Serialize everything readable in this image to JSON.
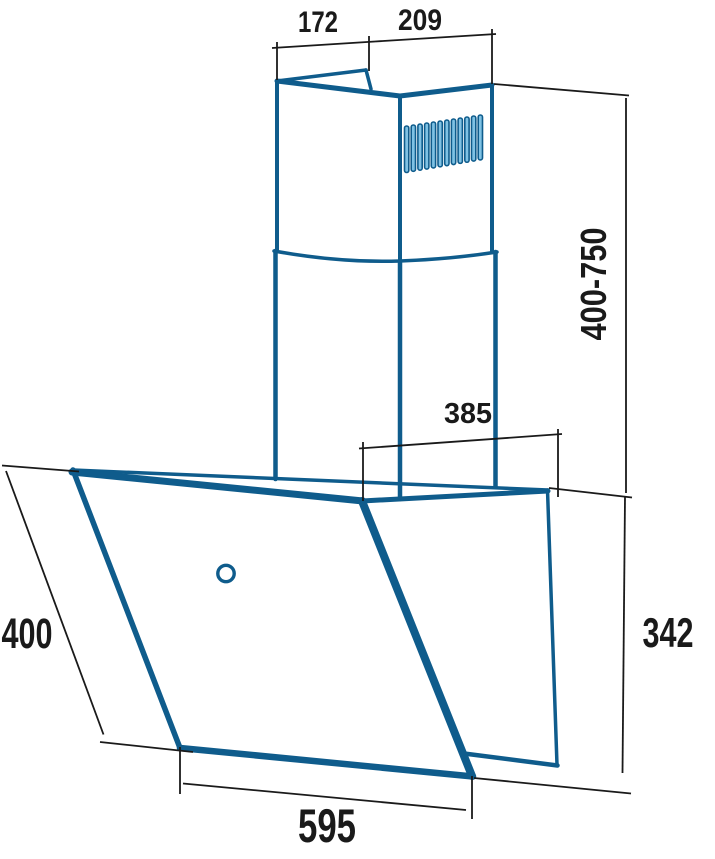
{
  "figure": {
    "type": "technical-dimension-drawing",
    "subject": "wall-mounted angled cooker hood with telescopic chimney, perspective view"
  },
  "colors": {
    "outline_blue": "#0F5C8C",
    "vent_slot_fill": "#7FC2E4",
    "dimension_black": "#1a1a1a",
    "background": "#ffffff"
  },
  "dimensions": {
    "chimney_left_face_width": "172",
    "chimney_right_face_width": "209",
    "chimney_height_range": "400-750",
    "hood_top_depth": "385",
    "hood_rear_height": "342",
    "hood_side_depth": "400",
    "hood_front_width": "595"
  },
  "vent_grille": {
    "slot_count": 12
  },
  "controls": {
    "power_button_count": 1
  }
}
